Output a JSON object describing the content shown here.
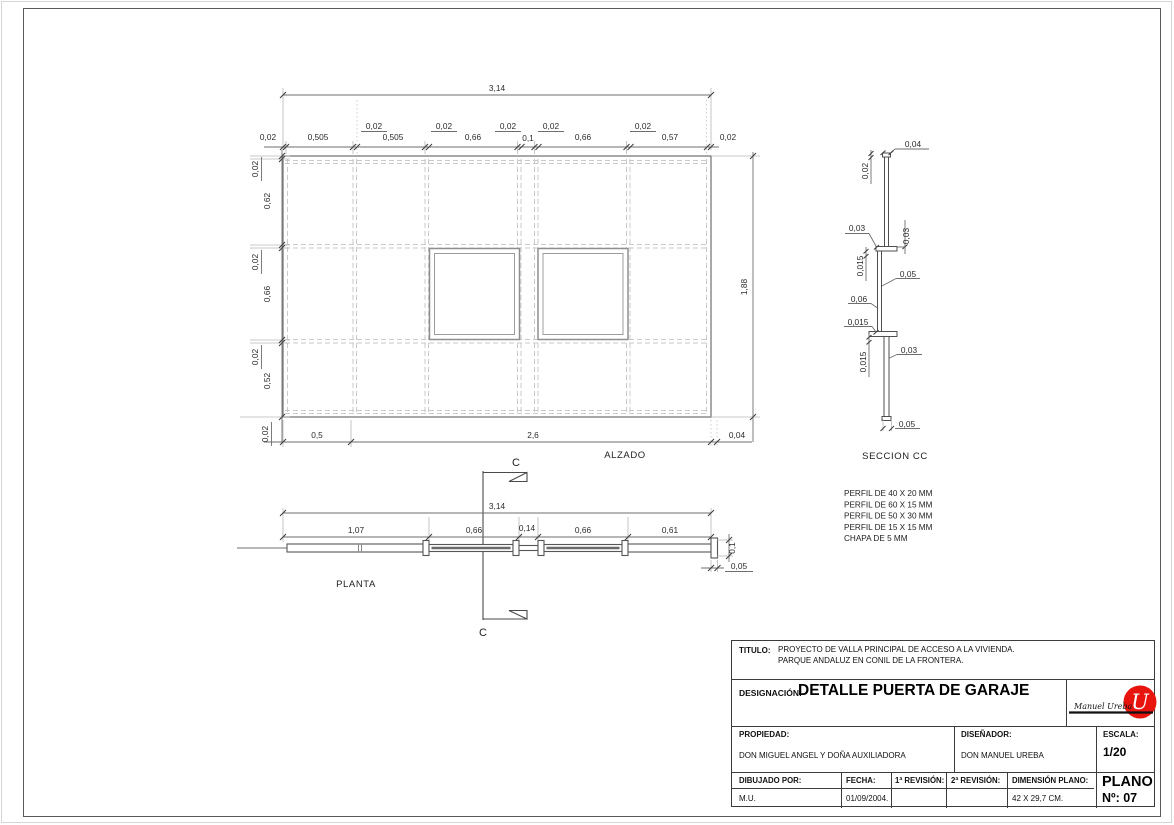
{
  "drawing": {
    "elevation": {
      "label": "ALZADO",
      "total_width": "3,14",
      "total_height": "1,88",
      "width_segments": [
        "0,02",
        "0,505",
        "0,02",
        "0,505",
        "0,02",
        "0,66",
        "0,02",
        "0,1",
        "0,02",
        "0,66",
        "0,02",
        "0,57",
        "0,02"
      ],
      "height_segments": [
        "0,02",
        "0,62",
        "0,02",
        "0,66",
        "0,02",
        "0,52",
        "0,02"
      ],
      "bottom_segments": [
        "0,5",
        "2,6",
        "0,04"
      ]
    },
    "plan": {
      "label": "PLANTA",
      "total_width": "3,14",
      "width_segments": [
        "1,07",
        "0,66",
        "0,14",
        "0,66",
        "0,61"
      ],
      "thickness": "0,1",
      "end_plate": "0,05"
    },
    "section": {
      "label": "SECCION CC",
      "dims": [
        "0,04",
        "0,02",
        "0,03",
        "0,03",
        "0,015",
        "0,05",
        "0,06",
        "0,015",
        "0,015",
        "0,03",
        "0,05"
      ]
    },
    "section_cut": {
      "top": "C",
      "bottom": "C"
    },
    "notes": [
      "PERFIL DE 40 X 20 MM",
      "PERFIL DE 60 X 15 MM",
      "PERFIL DE 50 X 30 MM",
      "PERFIL DE 15 X 15 MM",
      "CHAPA DE 5 MM"
    ]
  },
  "title_block": {
    "titulo_label": "TITULO:",
    "titulo_line1": "PROYECTO DE VALLA PRINCIPAL DE ACCESO A LA VIVIENDA.",
    "titulo_line2": "PARQUE ANDALUZ EN CONIL DE LA FRONTERA.",
    "designacion_label": "DESIGNACIÓN:",
    "designacion_value": "DETALLE PUERTA DE GARAJE",
    "propiedad_label": "PROPIEDAD:",
    "propiedad_value": "DON MIGUEL ANGEL Y DOÑA AUXILIADORA",
    "disenador_label": "DISEÑADOR:",
    "disenador_value": "DON MANUEL UREBA",
    "escala_label": "ESCALA:",
    "escala_value": "1/20",
    "dibujado_label": "DIBUJADO POR:",
    "dibujado_value": "M.U.",
    "fecha_label": "FECHA:",
    "fecha_value": "01/09/2004.",
    "rev1_label": "1ª REVISIÓN:",
    "rev1_value": "",
    "rev2_label": "2ª REVISIÓN:",
    "rev2_value": "",
    "dimension_label": "DIMENSIÓN PLANO:",
    "dimension_value": "42 X 29,7 CM.",
    "plano_label": "PLANO",
    "plano_value": "Nº: 07",
    "logo_signature": "Manuel Ureba",
    "logo_monogram": "U",
    "logo_color": "#e8150e"
  }
}
